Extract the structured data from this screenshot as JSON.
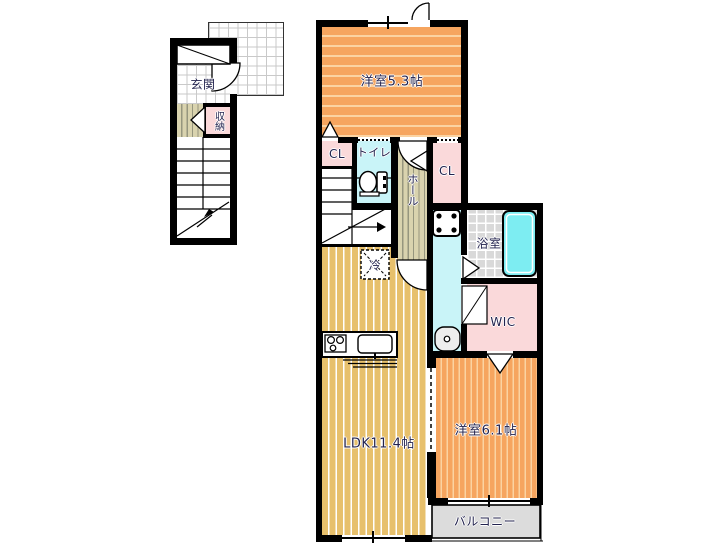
{
  "labels": {
    "entrance": "玄関",
    "storage": "収納",
    "western_room_5_3": "洋室5.3帖",
    "closet_left": "CL",
    "toilet": "トイレ",
    "hall": "ホール",
    "closet_right": "CL",
    "bathroom": "浴室",
    "walk_in_closet": "WIC",
    "refrigerator": "冷",
    "ldk": "LDK11.4帖",
    "western_room_6_1": "洋室6.1帖",
    "balcony": "バルコニー"
  },
  "colors": {
    "wall": "#000000",
    "room_orange": "#F6A55F",
    "room_orange_stripe": "#FBD3A2",
    "ldk_tan": "#E7C06C",
    "hall_beige": "#D9D3AE",
    "closet_pink": "#FAD9DA",
    "wet_area_cyan": "#C9F4F8",
    "bathtub_cyan": "#7DEDF2",
    "bath_tile_gray": "#D9D9D9",
    "balcony_gray": "#DCDCDC",
    "label_text": "#23234E"
  },
  "fixtures": [
    "toilet",
    "bathtub",
    "washing-machine",
    "washbasin",
    "kitchen-stove",
    "kitchen-sink",
    "refrigerator-space",
    "shoe-cabinet"
  ]
}
